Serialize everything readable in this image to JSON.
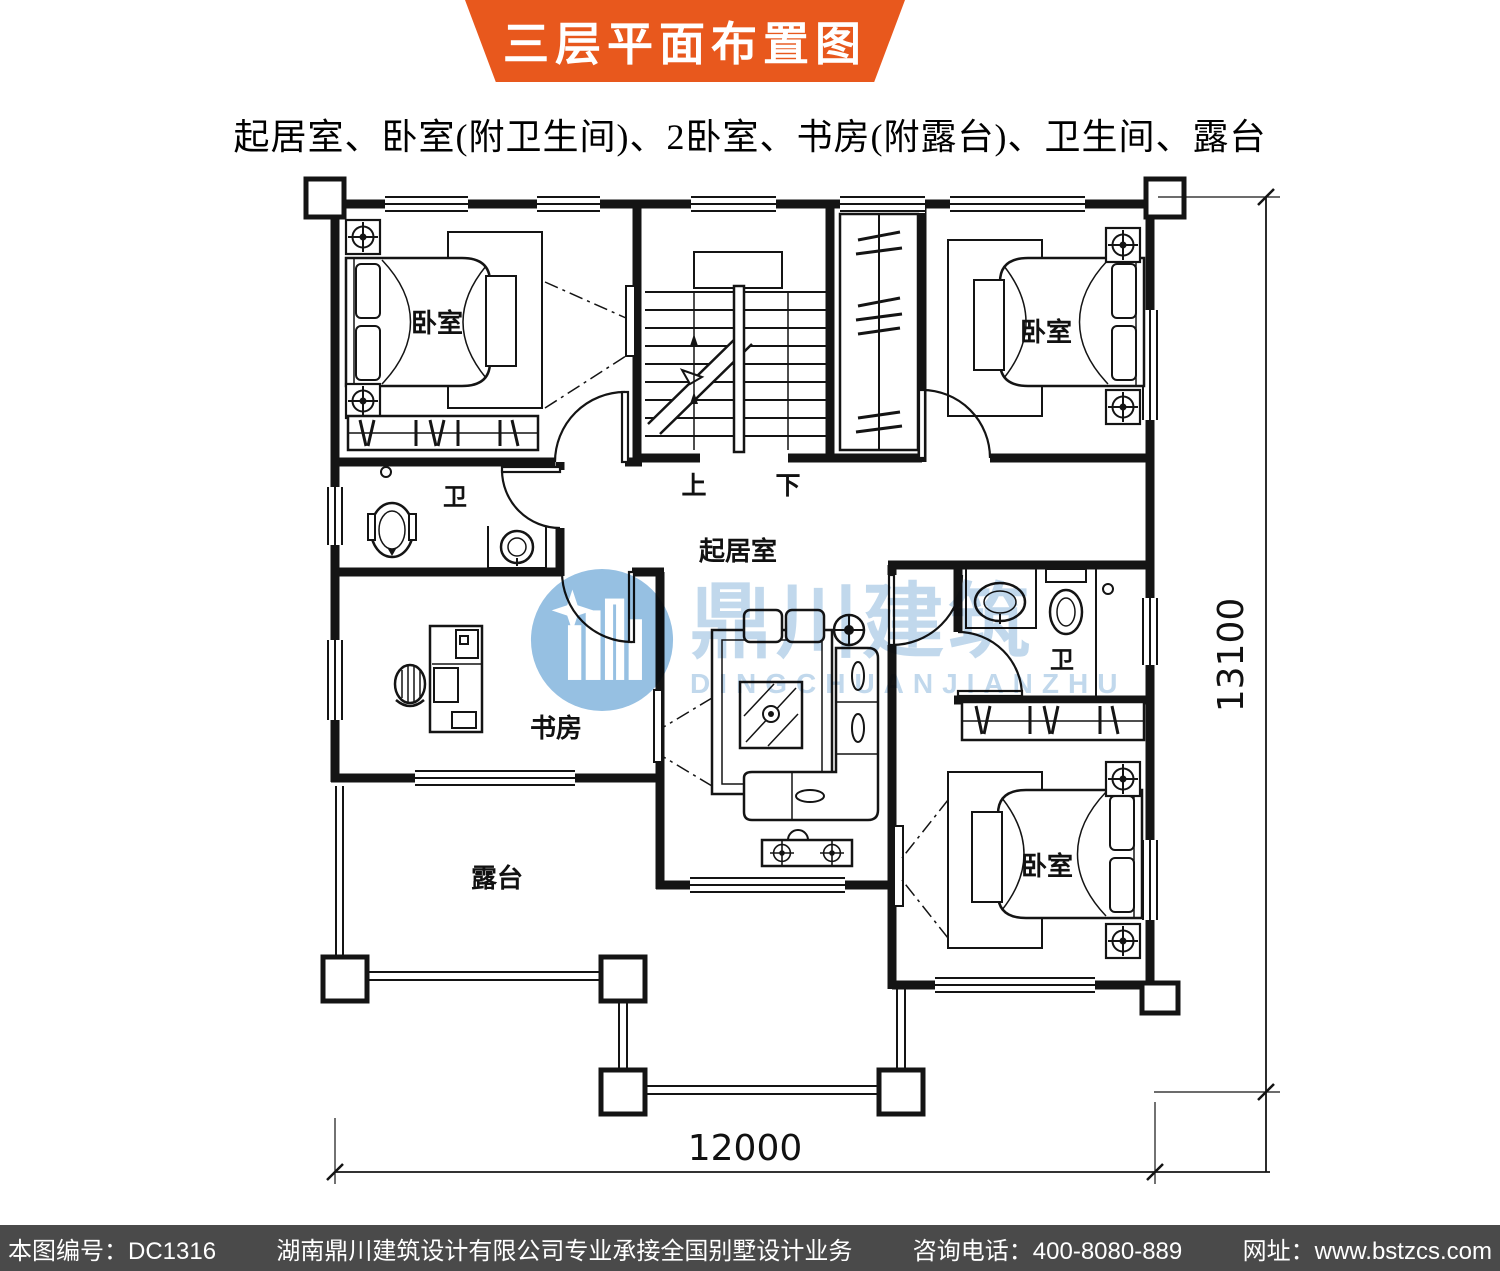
{
  "banner": {
    "title": "三层平面布置图"
  },
  "subtitle": "起居室、卧室(附卫生间)、2卧室、书房(附露台)、卫生间、露台",
  "plan": {
    "rooms": {
      "bedroom_tl": "卧室",
      "bedroom_tr": "卧室",
      "bedroom_br": "卧室",
      "bath_left": "卫",
      "bath_right": "卫",
      "living": "起居室",
      "study": "书房",
      "terrace": "露台"
    },
    "stairs": {
      "up": "上",
      "down": "下"
    },
    "dimensions": {
      "bottom": "12000",
      "right": "13100"
    }
  },
  "watermark": {
    "cn": "鼎川建筑",
    "en": "DINGCHUANJIANZHU"
  },
  "footer": {
    "items": [
      "本图编号：DC1316",
      "湖南鼎川建筑设计有限公司专业承接全国别墅设计业务",
      "咨询电话：400-8080-889",
      "网址：www.bstzcs.com"
    ]
  },
  "theme": {
    "banner_bg": "#E8581D",
    "banner_text": "#FFFFFF",
    "footer_bg": "#4A4A4A",
    "footer_text": "#FFFFFF",
    "line": "#141414",
    "watermark_blue": "#B3D0E8",
    "logo_blue": "#7FB2DC"
  }
}
